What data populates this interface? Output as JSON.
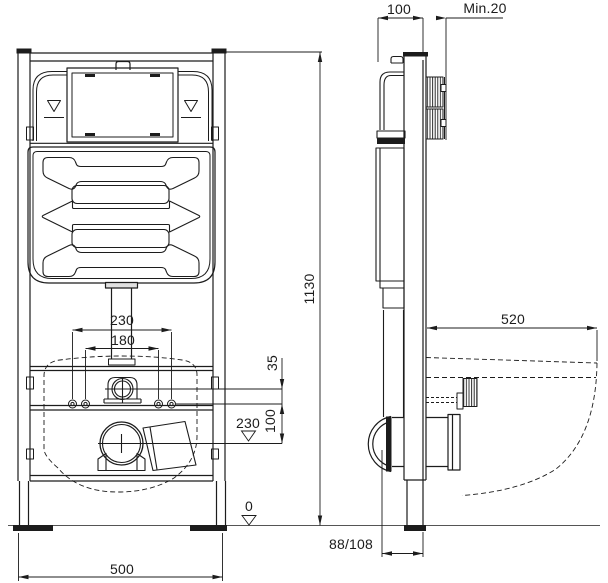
{
  "drawing": {
    "colors": {
      "line": "#1c1c1c",
      "background": "#ffffff",
      "collar_fill": "#e0e0e0"
    },
    "front_view": {
      "dims": {
        "frame_height": "1130",
        "frame_width": "500",
        "bolt_spacing_outer": "230",
        "bolt_spacing_inner": "180",
        "supply_to_bolts": "35",
        "bolts_to_outlet": "100",
        "outlet_height": "230",
        "floor_level": "0"
      }
    },
    "side_view": {
      "dims": {
        "frame_depth": "100",
        "min_wall_clearance": "Min.20",
        "bowl_depth": "520",
        "outlet_wall_offset": "88/108"
      }
    }
  }
}
